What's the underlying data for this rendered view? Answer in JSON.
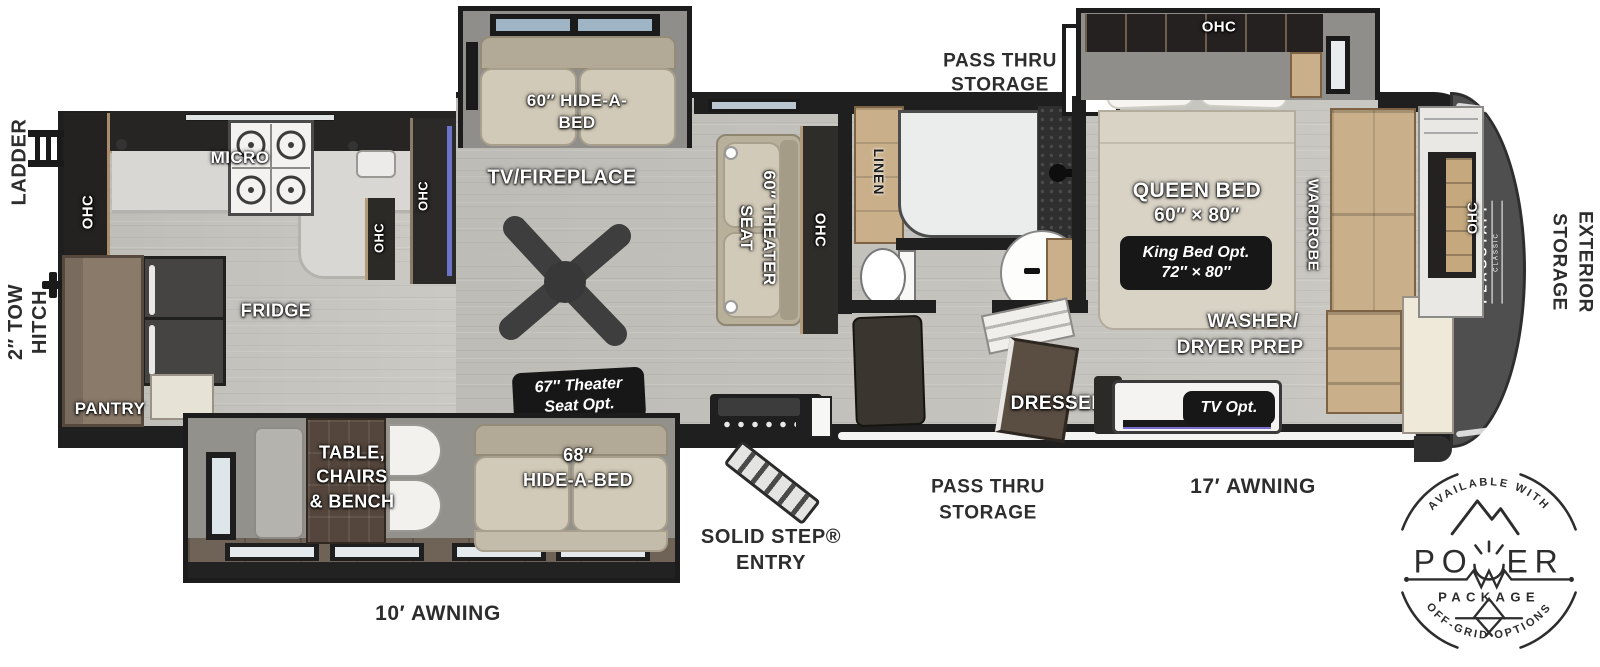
{
  "colors": {
    "wall": "#1f1f1f",
    "floor_main": "#c8c6c0",
    "floor_slide": "#6f6357",
    "cabinet_wood": "#c9b08a",
    "sofa": "#d2cab8",
    "front_cap": "#4f4f4f",
    "option_badge_bg": "#171717",
    "label_light": "#ffffff",
    "label_dark": "#2d2d2d"
  },
  "exterior": {
    "ladder": "LADDER",
    "tow_hitch_line1": "2″ TOW",
    "tow_hitch_line2": "HITCH",
    "pass_thru_top_line1": "PASS THRU",
    "pass_thru_top_line2": "STORAGE",
    "pass_thru_bottom_line1": "PASS THRU",
    "pass_thru_bottom_line2": "STORAGE",
    "solid_step_line1": "SOLID STEP®",
    "solid_step_line2": "ENTRY",
    "awning_17": "17′ AWNING",
    "awning_10": "10′ AWNING",
    "exterior_storage_line1": "EXTERIOR",
    "exterior_storage_line2": "STORAGE"
  },
  "kitchen": {
    "micro": "MICRO",
    "fridge": "FRIDGE",
    "pantry": "PANTRY",
    "ohc_rear": "OHC",
    "ohc_island": "OHC",
    "ohc_entertainment": "OHC"
  },
  "living": {
    "tv_fireplace": "TV/FIREPLACE",
    "hide_a_bed_line1": "60″ HIDE-A-",
    "hide_a_bed_line2": "BED",
    "theater_seat_line1": "60″ THEATER",
    "theater_seat_line2": "SEAT",
    "ohc_theater": "OHC",
    "theater_opt_line1": "67″ Theater",
    "theater_opt_line2": "Seat Opt."
  },
  "dinette": {
    "line1": "TABLE,",
    "line2": "CHAIRS",
    "line3": "& BENCH",
    "hide_a_bed_line1": "68″",
    "hide_a_bed_line2": "HIDE-A-BED"
  },
  "bath": {
    "linen": "LINEN"
  },
  "bedroom": {
    "ohc_slide": "OHC",
    "queen_line1": "QUEEN BED",
    "queen_line2": "60″ × 80″",
    "king_opt_line1": "King Bed Opt.",
    "king_opt_line2": "72″ × 80″",
    "wardrobe": "WARDROBE",
    "washer_line1": "WASHER/",
    "washer_line2": "DRYER PREP",
    "dresser": "DRESSER",
    "tv_opt": "TV Opt.",
    "ohc_front": "OHC"
  },
  "brand": {
    "name": "FLAGSTAFF",
    "series": "CLASSIC"
  },
  "power_badge": {
    "available_with": "AVAILABLE WITH",
    "power_left": "PO",
    "power_right": "ER",
    "package": "PACKAGE",
    "off_grid": "OFF-GRID OPTIONS"
  }
}
